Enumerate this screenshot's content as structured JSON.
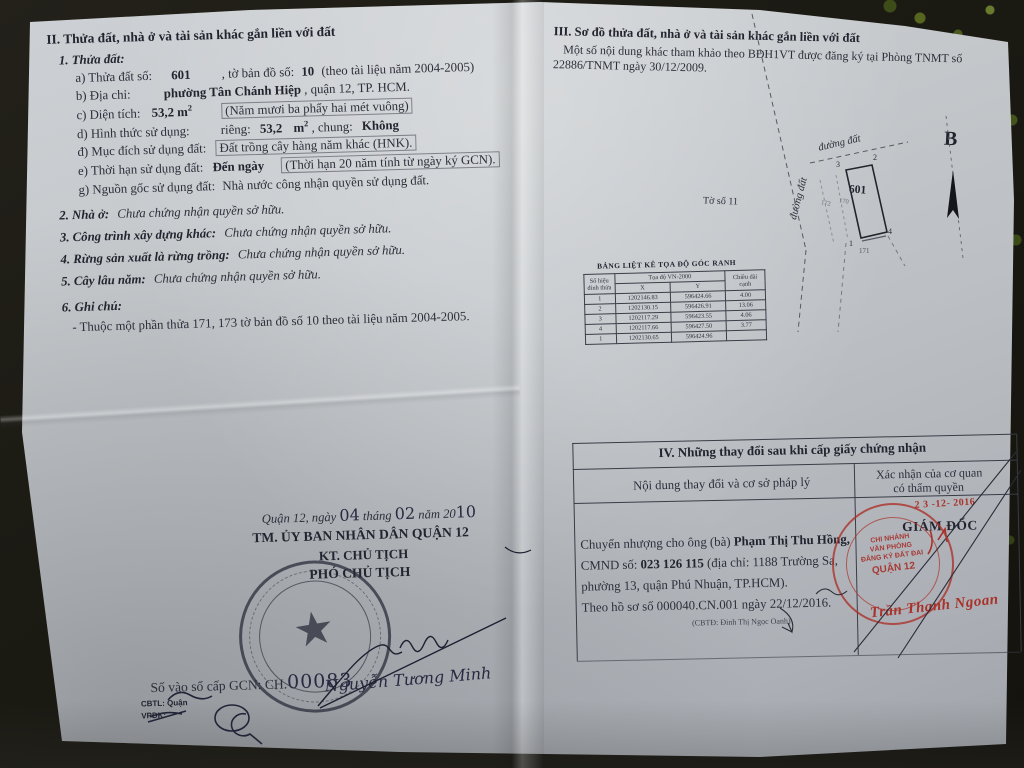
{
  "colors": {
    "paper": "#c6cacd",
    "ink": "#2d2e3a",
    "stamp_red": "#a8322a",
    "background": "#1b1a13"
  },
  "left_page": {
    "heading": "II. Thửa đất, nhà ở và tài sản khác gắn liền với đất",
    "item1_title": "1. Thửa đất:",
    "a": {
      "label": "a) Thửa đất số:",
      "num": "601",
      "mid": ", tờ bản đồ số:",
      "num2": "10",
      "tail": "(theo tài liệu năm 2004-2005)"
    },
    "b": {
      "label": "b) Địa chỉ:",
      "value": "phường Tân Chánh Hiệp",
      "tail": ", quận 12, TP. HCM."
    },
    "c": {
      "label": "c) Diện tích:",
      "value": "53,2",
      "unit": "m",
      "sup": "2",
      "tail": "(Năm mươi ba phẩy hai mét vuông)"
    },
    "d": {
      "label": "d) Hình thức sử dụng:",
      "rieng": "riêng:",
      "rieng_val": "53,2",
      "unit": "m",
      "sup": "2",
      "chung": ", chung:",
      "chung_val": "Không"
    },
    "dd": {
      "label": "đ) Mục đích sử dụng đất:",
      "value": "Đất trồng cây hàng năm khác (HNK)."
    },
    "e": {
      "label": "e) Thời hạn sử dụng đất:",
      "value": "Đến ngày",
      "tail": "(Thời hạn 20 năm tính từ ngày ký GCN)."
    },
    "g": {
      "label": "g) Nguồn gốc sử dụng đất:",
      "value": "Nhà nước công nhận quyền sử dụng đất."
    },
    "item2": {
      "label": "2. Nhà ở:",
      "value": "Chưa chứng nhận quyền sở hữu."
    },
    "item3": {
      "label": "3. Công trình xây dựng khác:",
      "value": "Chưa chứng nhận quyền sở hữu."
    },
    "item4": {
      "label": "4. Rừng sản xuất là rừng trồng:",
      "value": "Chưa chứng nhận quyền sở hữu."
    },
    "item5": {
      "label": "5. Cây lâu năm:",
      "value": "Chưa chứng nhận quyền sở hữu."
    },
    "item6": {
      "label": "6. Ghi chú:",
      "note": "- Thuộc một phần thửa 171, 173 tờ bản đồ số 10 theo tài liệu năm 2004-2005."
    },
    "sign_block": {
      "place": "Quận 12, ngày",
      "day": "04",
      "thang": "tháng",
      "month": "02",
      "nam": "năm 20",
      "year": "10",
      "committee": "TM. ỦY BAN NHÂN DÂN QUẬN 12",
      "kt": "KT. CHỦ TỊCH",
      "vice": "PHÓ CHỦ TỊCH",
      "signer": "Nguyễn Tương Minh"
    },
    "gcn": {
      "label": "Số vào sổ cấp GCN: CH.",
      "number": "00083",
      "cbtl": "CBTL: Quận",
      "vpdk": "VPĐK:"
    }
  },
  "right_page": {
    "heading": "III. Sơ đồ thửa đất, nhà ở và tài sản khác gắn liền với đất",
    "note1": "Một số nội dung khác tham khảo theo BĐH1VT được đăng ký tại Phòng TNMT số",
    "note2": "22886/TNMT ngày 30/12/2009.",
    "diagram": {
      "sheet": "Tờ số 11",
      "road_top": "đường đất",
      "road_left": "đường đất",
      "parcel": "601",
      "corner_tl": "3",
      "corner_tr": "2",
      "corner_bl": "1",
      "corner_br": "4",
      "adj_bottom": "171",
      "adj_left1": "172",
      "adj_left2": "170",
      "north": "B"
    },
    "coord_table": {
      "title": "BẢNG LIỆT KÊ TỌA ĐỘ GÓC RANH",
      "col_point": "Số hiệu đỉnh thửa",
      "col_coords": "Tọa độ VN-2000",
      "col_x": "X",
      "col_y": "Y",
      "col_len": "Chiều dài cạnh",
      "rows": [
        [
          "1",
          "1202146.83",
          "596424.66",
          "4.00"
        ],
        [
          "2",
          "1202130.15",
          "596426.91",
          "13.06"
        ],
        [
          "3",
          "1202117.29",
          "596423.55",
          "4.06"
        ],
        [
          "4",
          "1202117.66",
          "596427.50",
          "3.77"
        ],
        [
          "1",
          "1202130.65",
          "596424.96",
          ""
        ]
      ]
    },
    "section4": {
      "title": "IV. Những thay đổi sau khi cấp giấy chứng nhận",
      "col1": "Nội dung thay đổi và cơ sở pháp lý",
      "col2a": "Xác nhận của cơ quan",
      "col2b": "có thẩm quyền",
      "date_stamp": "2 3 -12- 2016",
      "director": "GIÁM ĐỐC",
      "body1_pre": "Chuyển nhượng cho ông (bà) ",
      "body1_name": "Phạm Thị Thu Hồng,",
      "body2_pre": "CMND số: ",
      "body2_num": "023 126 115",
      "body2_tail": " (địa chỉ: 1188 Trường Sa,",
      "body3": "phường 13, quận Phú Nhuận, TP.HCM).",
      "body4": "Theo hồ sơ số 000040.CN.001 ngày 22/12/2016.",
      "clerk": "(CBTĐ: Đinh Thị Ngọc Oanh)",
      "stamp": {
        "l1": "CHI NHÁNH",
        "l2": "VĂN PHÒNG",
        "l3": "ĐĂNG KÝ ĐẤT ĐAI",
        "l4": "QUẬN 12"
      },
      "signature": "Trần Thanh Ngoan"
    }
  }
}
